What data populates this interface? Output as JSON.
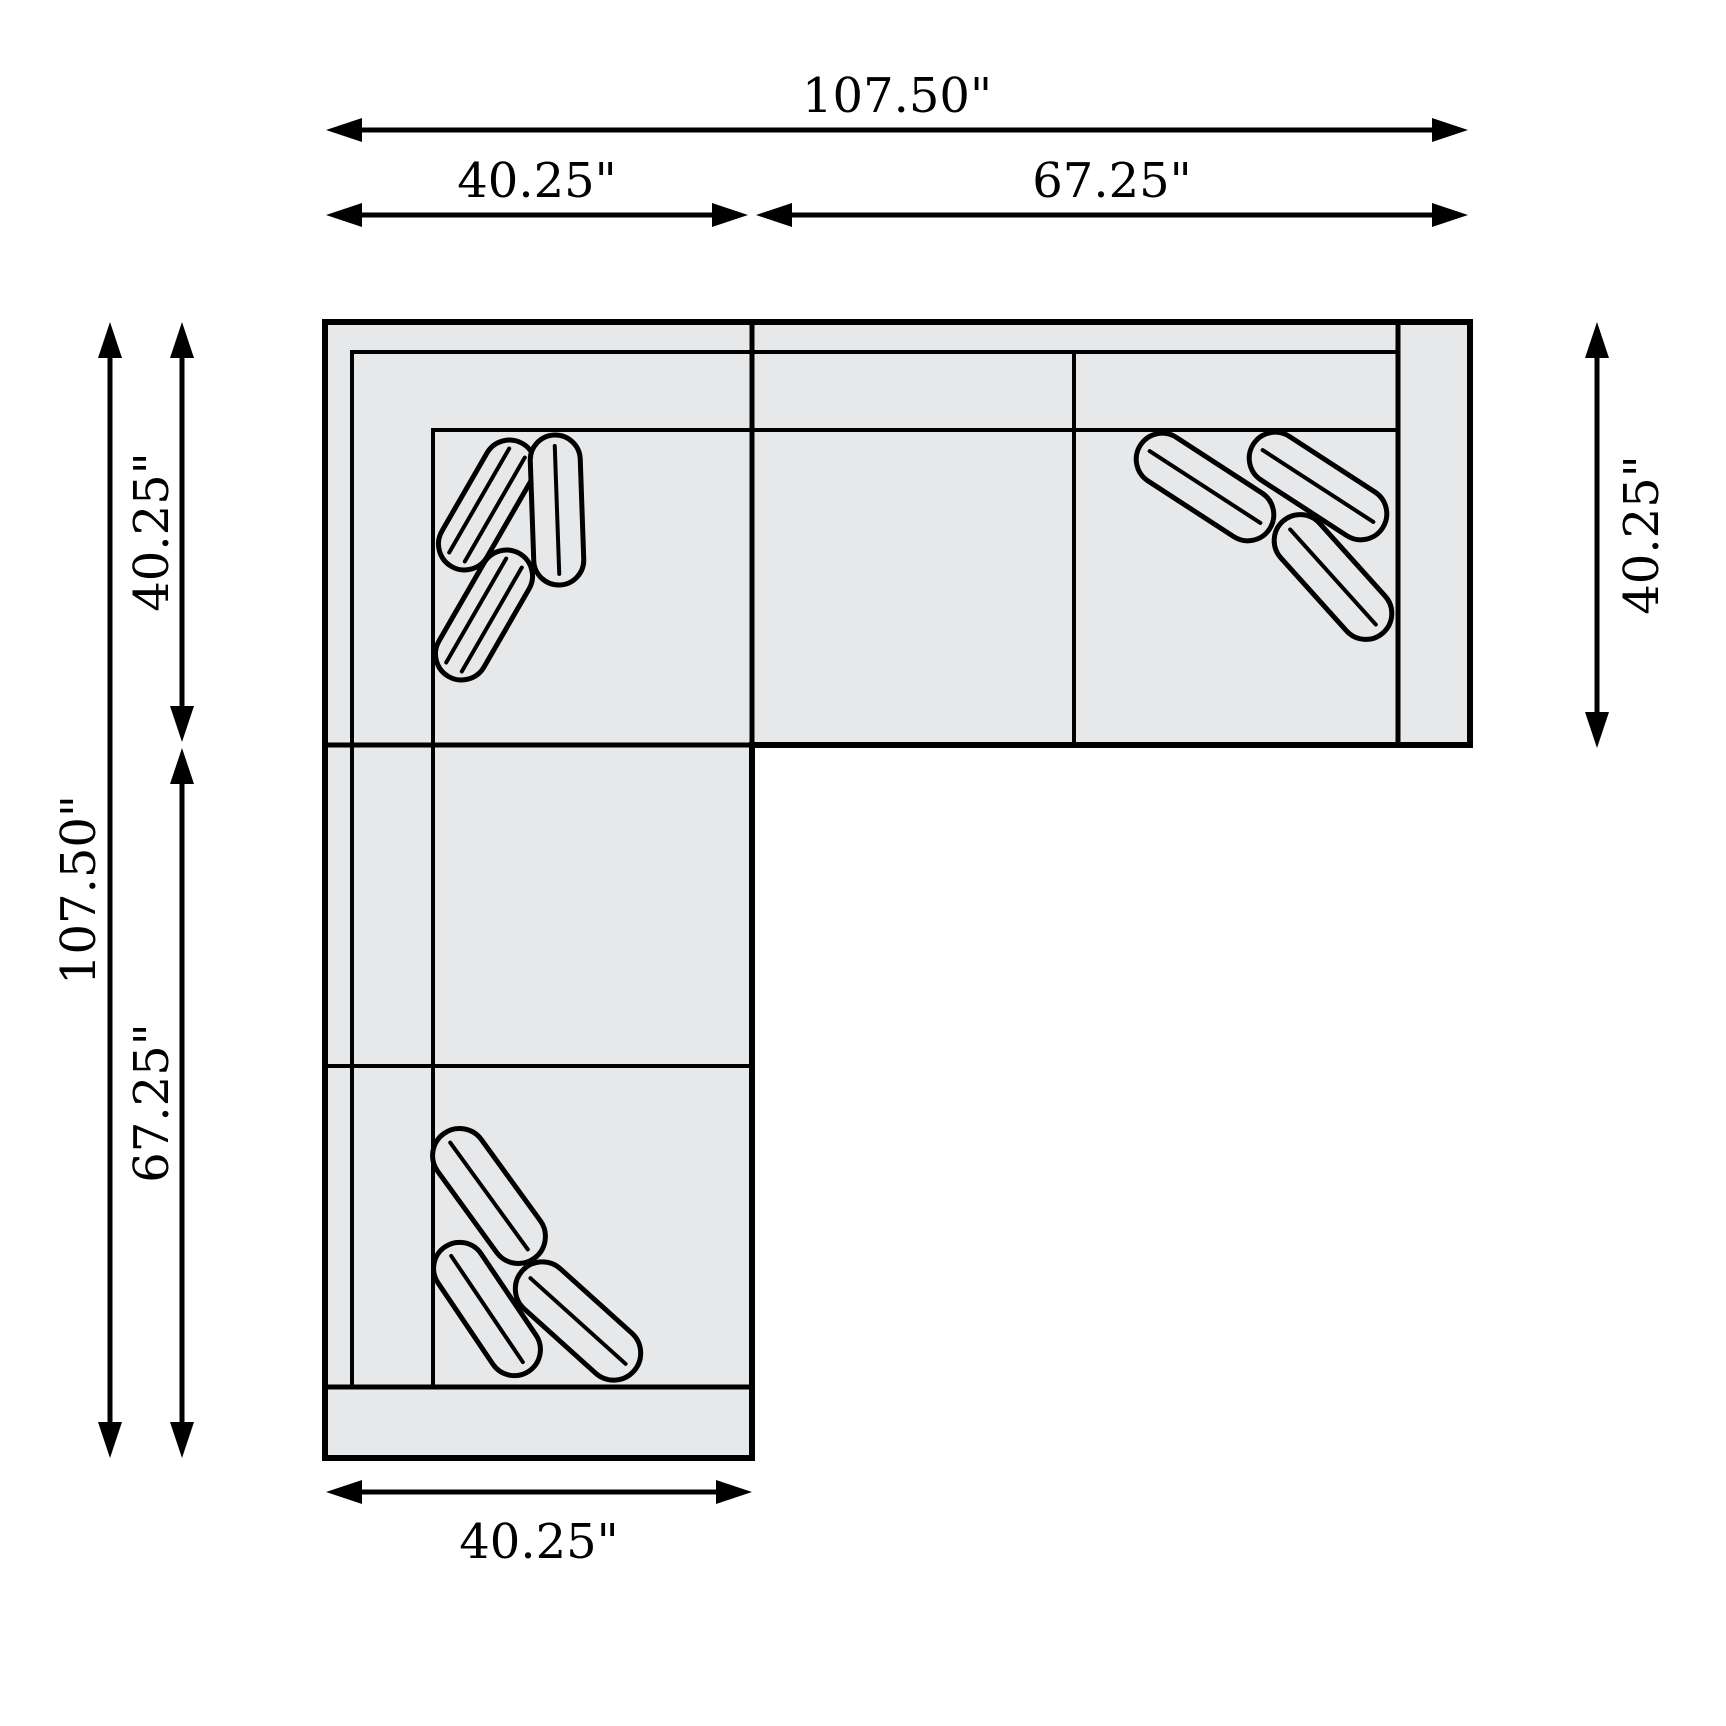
{
  "diagram": {
    "type": "sectional-sofa-floor-plan",
    "unit": "inches",
    "dimensions": {
      "overall_width": "107.50\"",
      "top_left_section_width": "40.25\"",
      "top_right_section_width": "67.25\"",
      "overall_height": "107.50\"",
      "left_top_section_height": "40.25\"",
      "left_bottom_section_height": "67.25\"",
      "right_side_depth": "40.25\"",
      "bottom_side_depth": "40.25\""
    },
    "colors": {
      "body_fill": "#e7e8ea",
      "line": "#000000",
      "background": "#ffffff"
    }
  }
}
